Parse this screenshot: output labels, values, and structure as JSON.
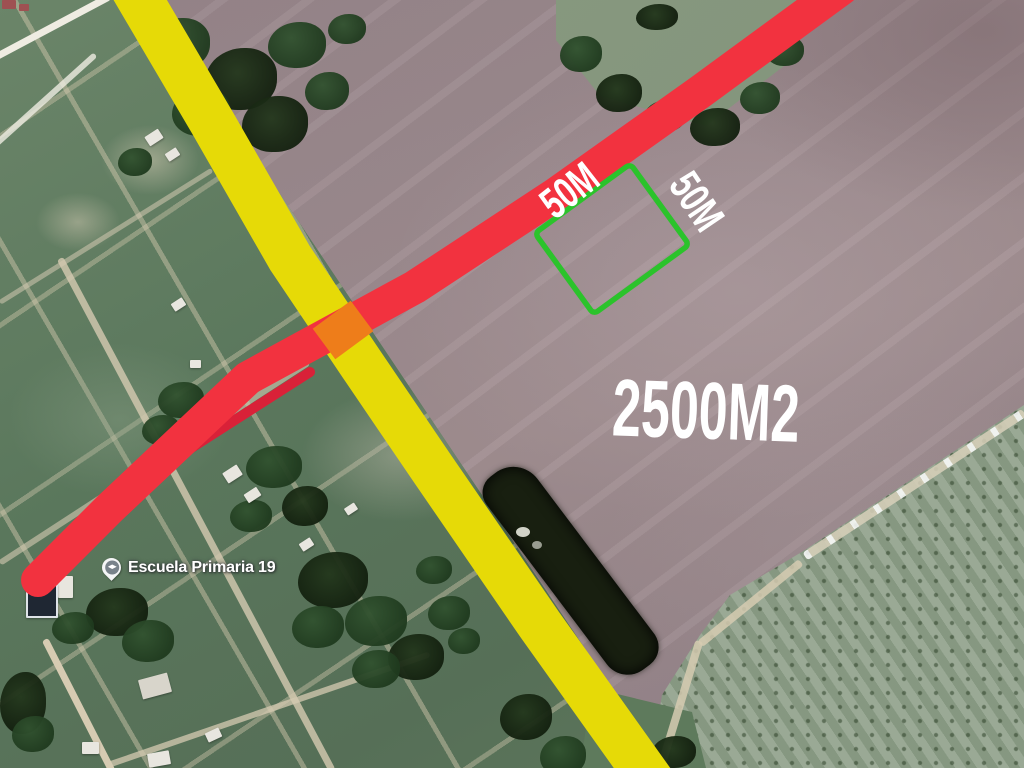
{
  "poi": {
    "label": "Escuela Primaria 19",
    "marker_type": "school-pin"
  },
  "annotations": {
    "area_label": "2500M2",
    "side_label_a": "50M",
    "side_label_b": "50M",
    "plot_outline_color": "#2bc32b",
    "highlighted_road_red_color": "#f2323f",
    "highlighted_road_yellow_color": "#e6da07",
    "intersection_highlight_color": "#ee7d1a",
    "label_text_color": "#ffffff"
  },
  "terrain": {
    "plowed_field_color": "#9a878b",
    "grass_field_color": "#5e7a5f",
    "orchard_color": "#91a28c",
    "tree_color": "#24411f",
    "dirt_road_color": "#d6cbb2"
  }
}
